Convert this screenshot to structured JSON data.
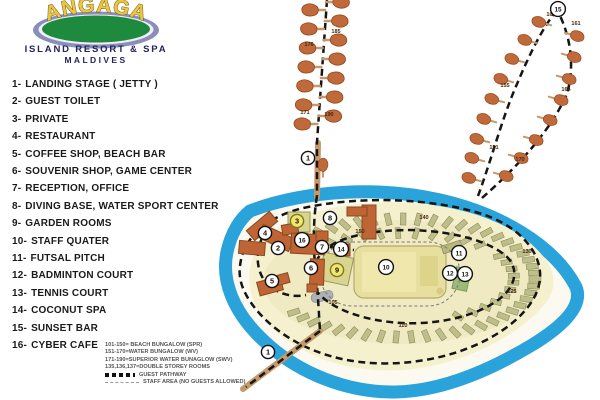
{
  "logo": {
    "resort_name": "ANGAGA",
    "line1": "ISLAND RESORT & SPA",
    "line2": "MALDIVES"
  },
  "legend": {
    "items": [
      {
        "num": "1-",
        "label": "LANDING STAGE ( JETTY )"
      },
      {
        "num": "2-",
        "label": "GUEST TOILET"
      },
      {
        "num": "3-",
        "label": "PRIVATE"
      },
      {
        "num": "4-",
        "label": "RESTAURANT"
      },
      {
        "num": "5-",
        "label": "COFFEE SHOP, BEACH BAR"
      },
      {
        "num": "6-",
        "label": "SOUVENIR SHOP, GAME CENTER"
      },
      {
        "num": "7-",
        "label": "RECEPTION, OFFICE"
      },
      {
        "num": "8-",
        "label": "DIVING BASE, WATER SPORT CENTER"
      },
      {
        "num": "9-",
        "label": "GARDEN ROOMS"
      },
      {
        "num": "10-",
        "label": "STAFF QUATER"
      },
      {
        "num": "11-",
        "label": "FUTSAL PITCH"
      },
      {
        "num": "12-",
        "label": "BADMINTON COURT"
      },
      {
        "num": "13-",
        "label": "TENNIS COURT"
      },
      {
        "num": "14-",
        "label": "COCONUT SPA"
      },
      {
        "num": "15-",
        "label": "SUNSET BAR"
      },
      {
        "num": "16-",
        "label": "CYBER CAFE"
      }
    ]
  },
  "room_key": {
    "lines": [
      "101-150= BEACH BUNGALOW (SPR)",
      "151-170=WATER BUNGALOW (WV)",
      "171-190=SUPERIOR WATER BUNAGLOW (SWV)",
      "135,136,137=DOUBLE STOREY ROOMS"
    ],
    "guest_pathway": "GUEST PATHWAY",
    "staff_area": "STAFF AREA (NO GUESTS ALLOWED)"
  },
  "map": {
    "markers": [
      {
        "label": "1",
        "x": 308,
        "y": 158
      },
      {
        "label": "1",
        "x": 268,
        "y": 352
      },
      {
        "label": "2",
        "x": 278,
        "y": 248
      },
      {
        "label": "3",
        "x": 297,
        "y": 221,
        "style": "yellow"
      },
      {
        "label": "4",
        "x": 265,
        "y": 233
      },
      {
        "label": "5",
        "x": 272,
        "y": 281
      },
      {
        "label": "6",
        "x": 311,
        "y": 268
      },
      {
        "label": "7",
        "x": 322,
        "y": 247
      },
      {
        "label": "8",
        "x": 330,
        "y": 218
      },
      {
        "label": "9",
        "x": 337,
        "y": 270,
        "style": "yellow"
      },
      {
        "label": "10",
        "x": 386,
        "y": 267
      },
      {
        "label": "11",
        "x": 459,
        "y": 253
      },
      {
        "label": "12",
        "x": 450,
        "y": 273
      },
      {
        "label": "13",
        "x": 465,
        "y": 274
      },
      {
        "label": "14",
        "x": 341,
        "y": 249
      },
      {
        "label": "15",
        "x": 558,
        "y": 9
      },
      {
        "label": "16",
        "x": 302,
        "y": 240
      }
    ],
    "room_labels": [
      {
        "text": "176",
        "x": 309,
        "y": 46
      },
      {
        "text": "185",
        "x": 336,
        "y": 33
      },
      {
        "text": "171",
        "x": 305,
        "y": 114
      },
      {
        "text": "190",
        "x": 329,
        "y": 116
      },
      {
        "text": "151",
        "x": 494,
        "y": 149
      },
      {
        "text": "155",
        "x": 505,
        "y": 87
      },
      {
        "text": "160",
        "x": 551,
        "y": 16
      },
      {
        "text": "161",
        "x": 576,
        "y": 25
      },
      {
        "text": "164",
        "x": 566,
        "y": 91
      },
      {
        "text": "170",
        "x": 520,
        "y": 161
      },
      {
        "text": "150",
        "x": 360,
        "y": 233
      },
      {
        "text": "140",
        "x": 424,
        "y": 219
      },
      {
        "text": "130",
        "x": 527,
        "y": 253
      },
      {
        "text": "125",
        "x": 512,
        "y": 293
      },
      {
        "text": "110",
        "x": 403,
        "y": 327
      },
      {
        "text": "105",
        "x": 333,
        "y": 304
      }
    ],
    "colors": {
      "reef_blue": "#2AA3DB",
      "island_sand": "#F5F0CE",
      "water_bungalow": "#C0693A",
      "beach_bungalow": "#BEBE8A",
      "building_orange": "#BF6434",
      "staff_building": "#E7DF9E",
      "walkway_tan": "#C49A6C",
      "pathway_black": "#151515",
      "logo_green": "#1E8A3E",
      "logo_purple": "#8B8DBA",
      "logo_yellow": "#F0C53C"
    }
  }
}
